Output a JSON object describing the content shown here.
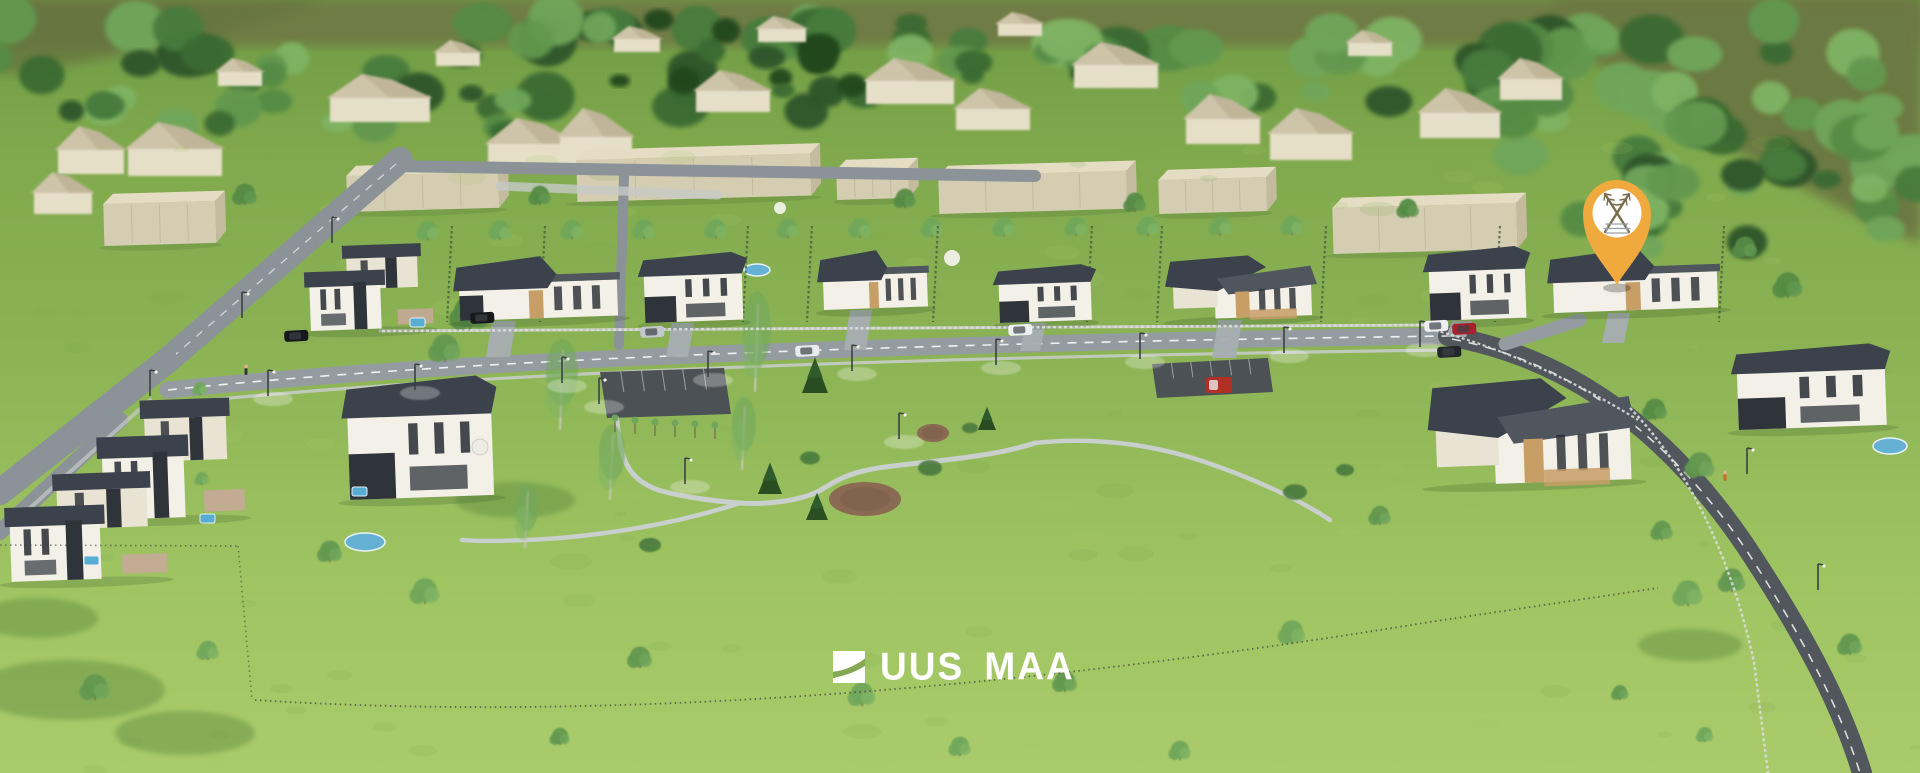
{
  "meta": {
    "type": "3d-aerial-render",
    "description": "Aerial 3D visualization of a suburban residential development: two rows of modern flat-roofed houses along a street, beige apartment blocks and village houses in the background forest, a park with winding paths, and an orange location pin marking one plot."
  },
  "branding": {
    "logo_text": "UUS MAA",
    "logo_color": "#ffffff"
  },
  "marker": {
    "x": 1617,
    "y": 230,
    "pin_color": "#efa93d",
    "emblem_bg": "#ffffff",
    "emblem_color": "#7a6d4c"
  },
  "colors": {
    "grass_top": "#6f9a44",
    "grass_mid": "#8bb354",
    "grass_low": "#9fc462",
    "grass_bottom": "#aacb6b",
    "olive": "#6f7c44",
    "olive_dark": "#667440",
    "forest": [
      "#2d5529",
      "#3a6a33",
      "#477c3c",
      "#548b45",
      "#62984f",
      "#70a65a",
      "#7fb364"
    ],
    "conifer": "#24471f",
    "road": "#949ca1",
    "road_dark": "#51575d",
    "road_upper": "#8b9298",
    "sidewalk": "#c6cbc7",
    "path": "#c9cfcc",
    "drive": "#a7aeb2",
    "roof": "#3c424b",
    "roof_light": "#50565e",
    "wall": "#f3f0e7",
    "wall_cream": "#e9e3d3",
    "wall_dark": "#2f343a",
    "wood": "#c79e66",
    "window": "#262a30",
    "block_front": "#d5cdb2",
    "block_top": "#e4ddc4",
    "block_side": "#c4bb9e",
    "bg_wall": "#e6dfc8",
    "bg_roof": "#cdc4a9",
    "bg_roof_shade": "#bdb295",
    "pool": "#64b1d4",
    "dirt": "#8b6a53",
    "hedge": "#46603a",
    "parking": "#4b5155",
    "white": "#ffffff"
  },
  "scene": {
    "olive_band": "M 0,0 H 1920 V 46 H 0 Z",
    "olive_right": "M 1555,0 H 1920 V 242 C 1800,192 1690,122 1598,62 L 1555,38 Z",
    "olive_left": "M 0,0 H 330 L 200,40 L 60,66 L 0,74 Z",
    "forest_clusters": [
      {
        "x0": -20,
        "x1": 1930,
        "y0": 16,
        "y1": 60,
        "n": 48,
        "rmin": 16,
        "rmax": 34,
        "seed": 7
      },
      {
        "x0": -20,
        "x1": 1930,
        "y0": 52,
        "y1": 112,
        "n": 42,
        "rmin": 13,
        "rmax": 30,
        "seed": 13
      },
      {
        "x0": 0,
        "x1": 560,
        "y0": 92,
        "y1": 132,
        "n": 14,
        "rmin": 12,
        "rmax": 24,
        "seed": 21
      },
      {
        "x0": 1500,
        "x1": 1930,
        "y0": 88,
        "y1": 182,
        "n": 24,
        "rmin": 16,
        "rmax": 32,
        "seed": 31
      },
      {
        "x0": 1570,
        "x1": 1930,
        "y0": 158,
        "y1": 250,
        "n": 16,
        "rmin": 14,
        "rmax": 28,
        "seed": 41
      },
      {
        "x0": 600,
        "x1": 1000,
        "y0": 14,
        "y1": 92,
        "n": 14,
        "rmin": 10,
        "rmax": 22,
        "seed": 51,
        "dark": true
      }
    ],
    "bg_houses": [
      [
        330,
        74,
        100,
        48
      ],
      [
        488,
        118,
        90,
        52
      ],
      [
        560,
        108,
        72,
        58
      ],
      [
        696,
        70,
        74,
        42
      ],
      [
        866,
        58,
        88,
        46
      ],
      [
        956,
        88,
        74,
        42
      ],
      [
        1074,
        42,
        84,
        46
      ],
      [
        1186,
        94,
        74,
        50
      ],
      [
        1270,
        108,
        82,
        52
      ],
      [
        1420,
        88,
        80,
        50
      ],
      [
        1500,
        58,
        62,
        42
      ],
      [
        58,
        126,
        66,
        48
      ],
      [
        128,
        122,
        94,
        54
      ],
      [
        34,
        172,
        58,
        42
      ],
      [
        614,
        26,
        46,
        26
      ],
      [
        758,
        16,
        48,
        26
      ],
      [
        998,
        12,
        44,
        24
      ],
      [
        436,
        40,
        44,
        26
      ],
      [
        218,
        58,
        44,
        28
      ],
      [
        1348,
        30,
        44,
        26
      ]
    ],
    "blocks": [
      [
        103,
        194,
        112,
        52
      ],
      [
        346,
        166,
        152,
        46
      ],
      [
        576,
        150,
        234,
        52
      ],
      [
        836,
        160,
        72,
        40
      ],
      [
        938,
        166,
        188,
        48
      ],
      [
        1158,
        170,
        108,
        44
      ],
      [
        1332,
        198,
        184,
        56
      ]
    ],
    "roads": [
      {
        "d": "M 400,160 L 168,360 L 0,492",
        "w": 26,
        "c": "road_upper"
      },
      {
        "d": "M 120,420 L 0,532",
        "w": 16,
        "c": "road_upper"
      },
      {
        "d": "M 388,166 L 1035,176",
        "w": 12,
        "c": "road_upper"
      },
      {
        "d": "M 624,176 L 619,345",
        "w": 10,
        "c": "road_upper"
      },
      {
        "d": "M 168,390 C 500,355 1000,342 1448,336",
        "w": 17,
        "c": "road"
      },
      {
        "d": "M 1448,336 C 1560,356 1660,420 1745,545 C 1800,628 1840,700 1862,773",
        "w": 20,
        "c": "road_dark"
      },
      {
        "d": "M 1580,320 L 1505,344",
        "w": 13,
        "c": "road"
      }
    ],
    "road_dashes": [
      {
        "d": "M 168,390 C 500,355 1000,342 1448,336",
        "w": 1.6,
        "dash": "9 8",
        "op": 0.85
      },
      {
        "d": "M 1452,339 C 1560,360 1660,424 1745,548 C 1798,630 1838,702 1860,773",
        "w": 1.6,
        "dash": "9 8",
        "op": 0.8
      },
      {
        "d": "M 396,164 L 176,354",
        "w": 1.4,
        "dash": "8 8",
        "op": 0.6
      }
    ],
    "sidewalks": [
      {
        "d": "M 380,331 L 1432,325",
        "w": 3,
        "c": "sidewalk",
        "op": 0.9
      },
      {
        "d": "M 170,404 C 500,369 1000,356 1444,350",
        "w": 3.2,
        "c": "sidewalk",
        "op": 0.9
      },
      {
        "d": "M 500,186 L 718,195",
        "w": 9,
        "c": "sidewalk",
        "op": 0.8
      },
      {
        "d": "M 30,508 L 150,400",
        "w": 4,
        "c": "sidewalk",
        "op": 0.7
      }
    ],
    "park_paths": [
      {
        "d": "M 1035,443 C 990,458 920,462 885,467 C 840,473 830,486 817,492 C 800,500 770,505 740,503 C 710,501 670,495 653,488 C 635,480 624,468 620,442",
        "w": 5
      },
      {
        "d": "M 740,503 C 700,516 640,531 560,538 C 518,541 488,542 462,540",
        "w": 4.5
      },
      {
        "d": "M 1035,443 C 1090,437 1150,443 1205,462 C 1255,479 1300,500 1330,520",
        "w": 4.5
      },
      {
        "d": "M 620,442 L 617,418",
        "w": 4
      }
    ],
    "parking_lots": [
      {
        "pts": "600,372 724,368 731,414 607,418"
      },
      {
        "pts": "1152,364 1268,358 1273,392 1157,398"
      }
    ],
    "street_houses": [
      {
        "x": 308,
        "y": 247,
        "w": 118,
        "h": 84,
        "kind": "duplex"
      },
      {
        "x": 458,
        "y": 259,
        "w": 158,
        "h": 62,
        "kind": "bungalow",
        "car": true
      },
      {
        "x": 643,
        "y": 255,
        "w": 98,
        "h": 68,
        "kind": "two-story"
      },
      {
        "x": 822,
        "y": 252,
        "w": 104,
        "h": 58,
        "kind": "bungalow"
      },
      {
        "x": 998,
        "y": 267,
        "w": 92,
        "h": 56,
        "kind": "two-story"
      },
      {
        "x": 1172,
        "y": 258,
        "w": 138,
        "h": 62,
        "kind": "l-bungalow"
      },
      {
        "x": 1428,
        "y": 249,
        "w": 96,
        "h": 72,
        "kind": "two-story"
      },
      {
        "x": 1552,
        "y": 251,
        "w": 164,
        "h": 62,
        "kind": "bungalow"
      }
    ],
    "foreground_houses": [
      {
        "x": 100,
        "y": 402,
        "w": 136,
        "h": 118,
        "kind": "duplex"
      },
      {
        "x": 8,
        "y": 476,
        "w": 150,
        "h": 106,
        "kind": "duplex"
      },
      {
        "x": 346,
        "y": 380,
        "w": 144,
        "h": 120,
        "kind": "two-story"
      },
      {
        "x": 1434,
        "y": 382,
        "w": 194,
        "h": 104,
        "kind": "l-bungalow"
      },
      {
        "x": 1736,
        "y": 348,
        "w": 148,
        "h": 82,
        "kind": "two-story"
      }
    ],
    "driveways": [
      [
        492,
        321,
        24,
        36
      ],
      [
        672,
        323,
        22,
        34
      ],
      [
        850,
        310,
        22,
        40
      ],
      [
        1026,
        323,
        20,
        28
      ],
      [
        1218,
        320,
        24,
        38
      ],
      [
        1452,
        321,
        20,
        16
      ],
      [
        1608,
        313,
        22,
        30
      ]
    ],
    "allee": {
      "x0": 428,
      "x1": 1292,
      "n": 13,
      "y": 240,
      "r": 9
    },
    "hedges": {
      "xs": [
        452,
        545,
        748,
        812,
        938,
        1092,
        1162,
        1326,
        1500,
        1724
      ],
      "y0": 226,
      "y1": 322
    },
    "fences": [
      {
        "d": "M 382,331 L 1430,325",
        "c": "#dadcd8",
        "w": 2.5,
        "dash": "3 2.5",
        "op": 0.95
      },
      {
        "d": "M 1430,329 C 1520,352 1600,396 1638,420",
        "c": "#dadcd8",
        "w": 2.2,
        "dash": "3 2.5",
        "op": 0.9
      },
      {
        "d": "M 1630,408 C 1692,472 1732,562 1754,662 L 1768,773",
        "c": "#dadcd8",
        "w": 2.5,
        "dash": "3 2.5",
        "op": 0.9
      },
      {
        "d": "M 255,700 C 600,722 1000,692 1430,622 L 1658,588",
        "c": "#3a4038",
        "w": 1.8,
        "dash": "1.5 3.5",
        "op": 0.7
      },
      {
        "d": "M 0,545 L 238,546",
        "c": "#3a4038",
        "w": 1.6,
        "dash": "1.5 3.5",
        "op": 0.6
      },
      {
        "d": "M 238,546 L 252,700",
        "c": "#3a4038",
        "w": 1.6,
        "dash": "1.5 3.5",
        "op": 0.55
      }
    ],
    "lamps_street": [
      [
        268,
        396
      ],
      [
        415,
        390
      ],
      [
        562,
        383
      ],
      [
        708,
        377
      ],
      [
        852,
        371
      ],
      [
        996,
        365
      ],
      [
        1140,
        359
      ],
      [
        1284,
        353
      ],
      [
        1420,
        347
      ]
    ],
    "lamps_park": [
      [
        599,
        404
      ],
      [
        685,
        484
      ],
      [
        899,
        439
      ]
    ],
    "lamps_road": [
      [
        1747,
        474
      ],
      [
        1818,
        590
      ],
      [
        150,
        396
      ],
      [
        242,
        318
      ],
      [
        332,
        243
      ]
    ],
    "cars": [
      [
        470,
        313,
        "#17191c"
      ],
      [
        640,
        327,
        "#c3c8cc"
      ],
      [
        795,
        346,
        "#e9ebec"
      ],
      [
        1008,
        325,
        "#eef0f1"
      ],
      [
        1424,
        321,
        "#eceef0"
      ],
      [
        1452,
        324,
        "#a6212c"
      ],
      [
        1437,
        347,
        "#24282c"
      ],
      [
        284,
        331,
        "#16181b"
      ]
    ],
    "truck": [
      1206,
      377,
      "#b03026"
    ],
    "ponds": [
      [
        365,
        542,
        20,
        9
      ],
      [
        757,
        270,
        13,
        6
      ],
      [
        1890,
        446,
        17,
        8
      ]
    ],
    "spas": [
      [
        200,
        514
      ],
      [
        352,
        487
      ],
      [
        410,
        318
      ],
      [
        84,
        556
      ]
    ],
    "dirt_patches": [
      [
        865,
        499,
        36,
        17
      ],
      [
        933,
        433,
        16,
        9
      ]
    ],
    "spruces": [
      [
        815,
        393,
        13,
        34
      ],
      [
        770,
        494,
        12,
        30
      ],
      [
        817,
        520,
        11,
        26
      ],
      [
        987,
        430,
        9,
        22
      ]
    ],
    "bushes": [
      [
        810,
        458,
        10
      ],
      [
        930,
        468,
        12
      ],
      [
        650,
        545,
        11
      ],
      [
        970,
        428,
        8
      ],
      [
        1295,
        492,
        12
      ],
      [
        1345,
        470,
        9
      ]
    ],
    "birches": [
      [
        560,
        430,
        16,
        80
      ],
      [
        610,
        500,
        13,
        66
      ],
      [
        525,
        548,
        11,
        56
      ],
      [
        755,
        392,
        14,
        88
      ],
      [
        742,
        470,
        12,
        64
      ]
    ],
    "trees": [
      [
        330,
        562,
        10,
        4
      ],
      [
        425,
        604,
        12,
        5
      ],
      [
        95,
        700,
        12,
        4
      ],
      [
        208,
        660,
        9,
        5
      ],
      [
        640,
        668,
        10,
        4
      ],
      [
        862,
        706,
        11,
        5
      ],
      [
        1065,
        692,
        10,
        4
      ],
      [
        1292,
        644,
        11,
        5
      ],
      [
        1380,
        525,
        9,
        4
      ],
      [
        1688,
        606,
        12,
        5
      ],
      [
        1850,
        655,
        10,
        4
      ],
      [
        960,
        756,
        9,
        5
      ],
      [
        560,
        745,
        8,
        4
      ],
      [
        1180,
        760,
        9,
        5
      ],
      [
        470,
        330,
        16,
        3
      ],
      [
        445,
        362,
        13,
        4
      ],
      [
        505,
        300,
        12,
        4
      ],
      [
        1655,
        420,
        10,
        3
      ],
      [
        1700,
        478,
        12,
        4
      ],
      [
        1662,
        540,
        9,
        4
      ],
      [
        1732,
        592,
        11,
        4
      ],
      [
        1745,
        258,
        10,
        3
      ],
      [
        1788,
        298,
        12,
        3
      ],
      [
        200,
        395,
        6,
        5
      ],
      [
        198,
        425,
        6,
        5
      ],
      [
        200,
        455,
        6,
        5
      ],
      [
        202,
        485,
        6,
        5
      ],
      [
        1620,
        700,
        7,
        4
      ],
      [
        1705,
        742,
        7,
        5
      ],
      [
        245,
        205,
        10,
        3
      ],
      [
        905,
        208,
        9,
        3
      ],
      [
        1135,
        212,
        9,
        3
      ],
      [
        540,
        205,
        9,
        3
      ],
      [
        1408,
        218,
        9,
        3
      ]
    ],
    "saplings_parking": [
      [
        615,
        426
      ],
      [
        635,
        428
      ],
      [
        655,
        430
      ],
      [
        675,
        431
      ],
      [
        695,
        432
      ],
      [
        715,
        433
      ]
    ],
    "shadow_blobs": [
      [
        70,
        690,
        95,
        30
      ],
      [
        185,
        733,
        70,
        22
      ],
      [
        38,
        618,
        60,
        20
      ],
      [
        1690,
        645,
        52,
        16
      ],
      [
        515,
        500,
        60,
        18
      ]
    ],
    "people": [
      [
        1725,
        474,
        "#c96a2a"
      ],
      [
        246,
        368,
        "#33373b"
      ]
    ],
    "parasols": [
      [
        952,
        258,
        8
      ],
      [
        780,
        208,
        6
      ]
    ],
    "table": [
      480,
      447,
      8
    ],
    "speckles": {
      "n": 150,
      "seed": 97
    }
  }
}
